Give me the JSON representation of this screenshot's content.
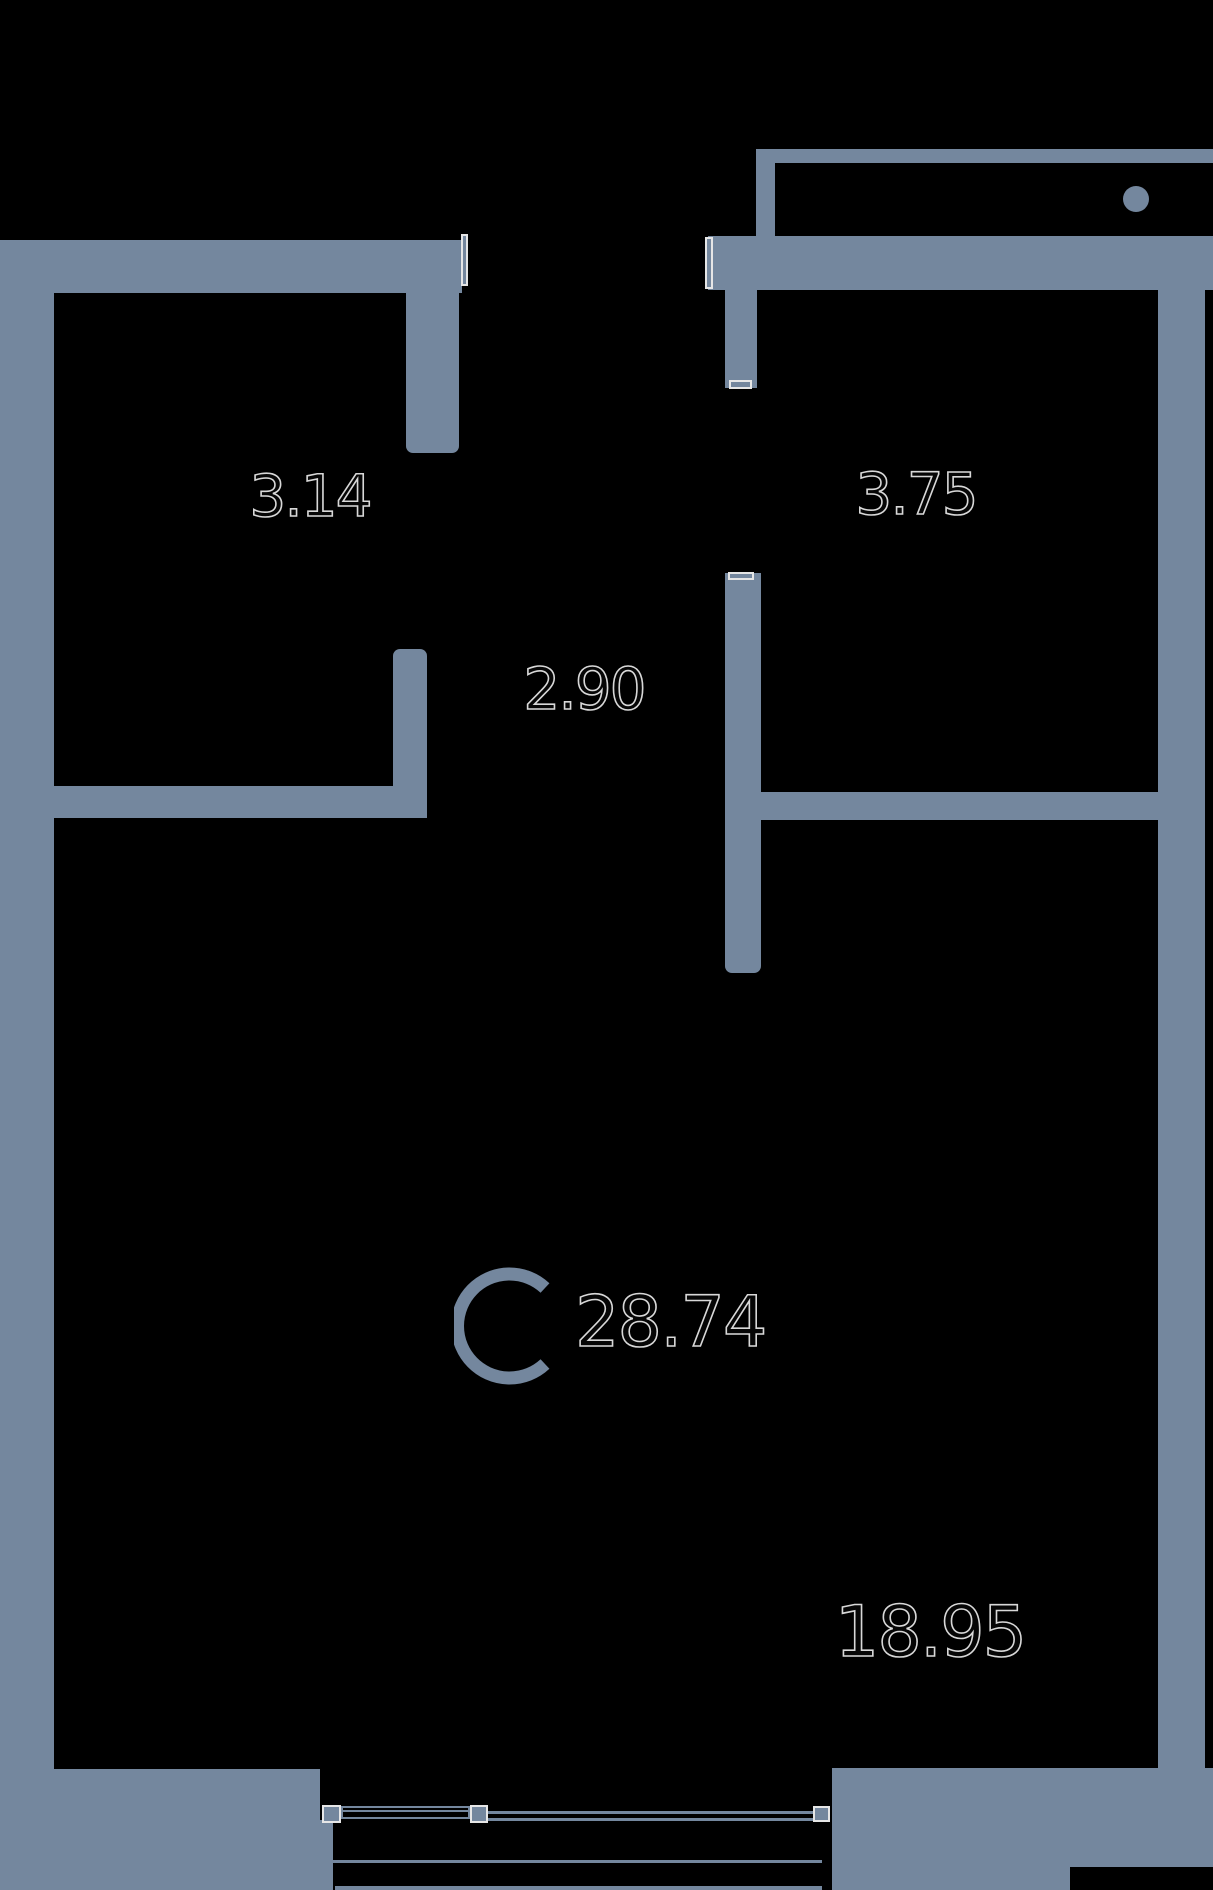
{
  "plan": {
    "unit_letter": "C",
    "total_area": "28.74",
    "labels": {
      "room_top_left_width": "3.14",
      "room_top_right_width": "3.75",
      "hallway_width": "2.90",
      "living_room_area": "18.95"
    },
    "colors": {
      "wall": "#74879E",
      "background": "#000000",
      "label_outline": "#D8D8D8",
      "window_cap_outline": "#E6E6E6"
    }
  }
}
